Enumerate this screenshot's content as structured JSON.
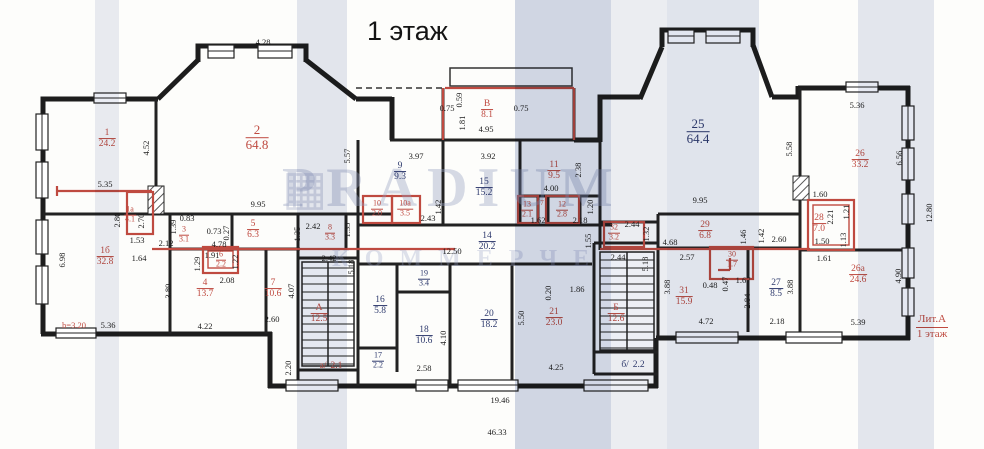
{
  "title": "1 этаж",
  "litera": {
    "line1": "Лит.А",
    "line2": "1 этаж"
  },
  "watermark": {
    "logo_icon": "grid-logo",
    "line1": "PRADIUM",
    "line2": "КОММЕРЧЕ"
  },
  "colors": {
    "markup_red": "#bf4a40",
    "room_blue": "#2f3b6e",
    "wall_black": "#1d1d1d",
    "scan_stripe": "#b7c0d8"
  },
  "rooms": [
    {
      "id": "1",
      "area": "24.2",
      "x": 107,
      "y": 139,
      "c": "r"
    },
    {
      "id": "2",
      "area": "64.8",
      "x": 257,
      "y": 138,
      "c": "r",
      "lg": 1
    },
    {
      "id": "1а",
      "area": "4.1",
      "x": 130,
      "y": 215,
      "c": "r",
      "sm": 1
    },
    {
      "id": "1б",
      "area": "32.8",
      "x": 105,
      "y": 257,
      "c": "r"
    },
    {
      "id": "3",
      "area": "3.1",
      "x": 184,
      "y": 235,
      "c": "r",
      "sm": 1
    },
    {
      "id": "4",
      "area": "13.7",
      "x": 205,
      "y": 289,
      "c": "r"
    },
    {
      "id": "5",
      "area": "6.3",
      "x": 253,
      "y": 230,
      "c": "r"
    },
    {
      "id": "6",
      "area": "2.2",
      "x": 221,
      "y": 260,
      "c": "r",
      "sm": 1
    },
    {
      "id": "7",
      "area": "10.6",
      "x": 273,
      "y": 289,
      "c": "r"
    },
    {
      "id": "8",
      "area": "3.3",
      "x": 330,
      "y": 233,
      "c": "r",
      "sm": 1
    },
    {
      "id": "9",
      "area": "9.3",
      "x": 400,
      "y": 172,
      "c": "b"
    },
    {
      "id": "10",
      "area": "2.0",
      "x": 377,
      "y": 209,
      "c": "r",
      "sm": 1
    },
    {
      "id": "10а",
      "area": "3.5",
      "x": 405,
      "y": 209,
      "c": "r",
      "sm": 1
    },
    {
      "id": "В",
      "area": "8.1",
      "x": 487,
      "y": 110,
      "c": "r"
    },
    {
      "id": "15",
      "area": "15.2",
      "x": 484,
      "y": 188,
      "c": "b"
    },
    {
      "id": "11",
      "area": "9.5",
      "x": 554,
      "y": 171,
      "c": "r"
    },
    {
      "id": "13",
      "area": "2.1",
      "x": 527,
      "y": 210,
      "c": "r",
      "sm": 1
    },
    {
      "id": "12",
      "area": "2.8",
      "x": 562,
      "y": 210,
      "c": "r",
      "sm": 1
    },
    {
      "id": "14",
      "area": "20.2",
      "x": 487,
      "y": 242,
      "c": "b"
    },
    {
      "id": "19",
      "area": "3.4",
      "x": 424,
      "y": 279,
      "c": "b",
      "sm": 1
    },
    {
      "id": "16",
      "area": "5.8",
      "x": 380,
      "y": 306,
      "c": "b"
    },
    {
      "id": "18",
      "area": "10.6",
      "x": 424,
      "y": 336,
      "c": "b"
    },
    {
      "id": "20",
      "area": "18.2",
      "x": 489,
      "y": 320,
      "c": "b"
    },
    {
      "id": "17",
      "area": "2.2",
      "x": 378,
      "y": 361,
      "c": "b",
      "sm": 1
    },
    {
      "id": "А",
      "area": "12.5",
      "x": 319,
      "y": 314,
      "c": "r"
    },
    {
      "id": "а/",
      "area": "2.1",
      "x": 330,
      "y": 366,
      "c": "r",
      "inline": 1
    },
    {
      "id": "21",
      "area": "23.0",
      "x": 554,
      "y": 318,
      "c": "r"
    },
    {
      "id": "Б",
      "area": "12.6",
      "x": 616,
      "y": 314,
      "c": "r"
    },
    {
      "id": "б/",
      "area": "2.2",
      "x": 632,
      "y": 365,
      "c": "b",
      "inline": 1
    },
    {
      "id": "25",
      "area": "64.4",
      "x": 698,
      "y": 132,
      "c": "b",
      "lg": 1
    },
    {
      "id": "29",
      "area": "6.8",
      "x": 705,
      "y": 231,
      "c": "r"
    },
    {
      "id": "30",
      "area": "1.7",
      "x": 732,
      "y": 260,
      "c": "r",
      "sm": 1
    },
    {
      "id": "31",
      "area": "15.9",
      "x": 684,
      "y": 297,
      "c": "r"
    },
    {
      "id": "27",
      "area": "8.5",
      "x": 776,
      "y": 289,
      "c": "b"
    },
    {
      "id": "32",
      "area": "3.2",
      "x": 614,
      "y": 233,
      "c": "r",
      "sm": 1
    },
    {
      "id": "28",
      "area": "7.0",
      "x": 819,
      "y": 224,
      "c": "r"
    },
    {
      "id": "26",
      "area": "33.2",
      "x": 860,
      "y": 160,
      "c": "r"
    },
    {
      "id": "26а",
      "area": "24.6",
      "x": 858,
      "y": 275,
      "c": "r"
    }
  ],
  "dims": [
    {
      "t": "4.28",
      "x": 263,
      "y": 42
    },
    {
      "t": "5.35",
      "x": 105,
      "y": 184
    },
    {
      "t": "4.52",
      "x": 146,
      "y": 148,
      "v": 1
    },
    {
      "t": "5.57",
      "x": 347,
      "y": 156,
      "v": 1
    },
    {
      "t": "9.95",
      "x": 258,
      "y": 204
    },
    {
      "t": "6.98",
      "x": 62,
      "y": 260,
      "v": 1
    },
    {
      "t": "2.80",
      "x": 117,
      "y": 220,
      "v": 1
    },
    {
      "t": "2.70",
      "x": 141,
      "y": 221,
      "v": 1
    },
    {
      "t": "1.53",
      "x": 137,
      "y": 240
    },
    {
      "t": "1.64",
      "x": 139,
      "y": 258
    },
    {
      "t": "5.36",
      "x": 108,
      "y": 325
    },
    {
      "t": "h=3.20",
      "x": 74,
      "y": 325,
      "red": 1
    },
    {
      "t": "2.12",
      "x": 166,
      "y": 243
    },
    {
      "t": "1.39",
      "x": 173,
      "y": 227,
      "v": 1
    },
    {
      "t": "0.83",
      "x": 187,
      "y": 218
    },
    {
      "t": "0.73",
      "x": 214,
      "y": 231
    },
    {
      "t": "0.27",
      "x": 226,
      "y": 233,
      "v": 1
    },
    {
      "t": "4.78",
      "x": 219,
      "y": 244
    },
    {
      "t": "1.29",
      "x": 197,
      "y": 264,
      "v": 1
    },
    {
      "t": "1.91",
      "x": 212,
      "y": 255
    },
    {
      "t": "1.22",
      "x": 235,
      "y": 262,
      "v": 1
    },
    {
      "t": "2.08",
      "x": 227,
      "y": 280
    },
    {
      "t": "3.89",
      "x": 168,
      "y": 291,
      "v": 1
    },
    {
      "t": "4.22",
      "x": 205,
      "y": 326
    },
    {
      "t": "2.60",
      "x": 272,
      "y": 319
    },
    {
      "t": "4.07",
      "x": 291,
      "y": 291,
      "v": 1
    },
    {
      "t": "2.42",
      "x": 313,
      "y": 226
    },
    {
      "t": "2.42",
      "x": 329,
      "y": 258
    },
    {
      "t": "1.35",
      "x": 297,
      "y": 234,
      "v": 1
    },
    {
      "t": "1.35",
      "x": 347,
      "y": 230,
      "v": 1
    },
    {
      "t": "5.18",
      "x": 351,
      "y": 267,
      "v": 1
    },
    {
      "t": "2.20",
      "x": 288,
      "y": 368,
      "v": 1
    },
    {
      "t": "3.97",
      "x": 416,
      "y": 156
    },
    {
      "t": "3.92",
      "x": 488,
      "y": 156
    },
    {
      "t": "4.95",
      "x": 486,
      "y": 129
    },
    {
      "t": "1.81",
      "x": 462,
      "y": 123,
      "v": 1
    },
    {
      "t": "0.59",
      "x": 459,
      "y": 100,
      "v": 1
    },
    {
      "t": "0.75",
      "x": 447,
      "y": 108
    },
    {
      "t": "0.75",
      "x": 521,
      "y": 108
    },
    {
      "t": "2.43",
      "x": 428,
      "y": 218
    },
    {
      "t": "1.42",
      "x": 438,
      "y": 207,
      "v": 1
    },
    {
      "t": "12.50",
      "x": 452,
      "y": 251
    },
    {
      "t": "2.58",
      "x": 424,
      "y": 368
    },
    {
      "t": "4.10",
      "x": 443,
      "y": 338,
      "v": 1
    },
    {
      "t": "2.38",
      "x": 578,
      "y": 170,
      "v": 1
    },
    {
      "t": "4.00",
      "x": 551,
      "y": 188
    },
    {
      "t": "7",
      "x": 542,
      "y": 203,
      "red": 1,
      "sm": 1
    },
    {
      "t": "1.62",
      "x": 538,
      "y": 220
    },
    {
      "t": "2.18",
      "x": 580,
      "y": 220
    },
    {
      "t": "1.20",
      "x": 590,
      "y": 207,
      "v": 1
    },
    {
      "t": "1.55",
      "x": 588,
      "y": 241,
      "v": 1
    },
    {
      "t": "0.20",
      "x": 548,
      "y": 293,
      "v": 1
    },
    {
      "t": "1.86",
      "x": 577,
      "y": 289
    },
    {
      "t": "5.50",
      "x": 521,
      "y": 318,
      "v": 1
    },
    {
      "t": "4.25",
      "x": 556,
      "y": 367
    },
    {
      "t": "2.44",
      "x": 632,
      "y": 224
    },
    {
      "t": "1.32",
      "x": 646,
      "y": 234,
      "v": 1
    },
    {
      "t": "2.44",
      "x": 618,
      "y": 257
    },
    {
      "t": "5.18",
      "x": 645,
      "y": 264,
      "v": 1
    },
    {
      "t": "9.95",
      "x": 700,
      "y": 200
    },
    {
      "t": "4.68",
      "x": 670,
      "y": 242
    },
    {
      "t": "2.57",
      "x": 687,
      "y": 257
    },
    {
      "t": "1.46",
      "x": 743,
      "y": 237,
      "v": 1
    },
    {
      "t": "1.42",
      "x": 761,
      "y": 236,
      "v": 1
    },
    {
      "t": "2.60",
      "x": 779,
      "y": 239
    },
    {
      "t": "0.48",
      "x": 710,
      "y": 285
    },
    {
      "t": "0.47",
      "x": 725,
      "y": 284,
      "v": 1
    },
    {
      "t": "1.67",
      "x": 743,
      "y": 280
    },
    {
      "t": "2.84",
      "x": 747,
      "y": 301,
      "v": 1
    },
    {
      "t": "3.88",
      "x": 667,
      "y": 287,
      "v": 1
    },
    {
      "t": "3.88",
      "x": 790,
      "y": 287,
      "v": 1
    },
    {
      "t": "4.72",
      "x": 706,
      "y": 321
    },
    {
      "t": "2.18",
      "x": 777,
      "y": 321
    },
    {
      "t": "5.36",
      "x": 857,
      "y": 105
    },
    {
      "t": "5.58",
      "x": 789,
      "y": 149,
      "v": 1
    },
    {
      "t": "6.56",
      "x": 899,
      "y": 158,
      "v": 1
    },
    {
      "t": "1.60",
      "x": 820,
      "y": 194
    },
    {
      "t": "2.21",
      "x": 830,
      "y": 217,
      "v": 1
    },
    {
      "t": "1.21",
      "x": 846,
      "y": 212,
      "v": 1
    },
    {
      "t": "1.50",
      "x": 822,
      "y": 241
    },
    {
      "t": "1.13",
      "x": 843,
      "y": 240,
      "v": 1
    },
    {
      "t": "1.61",
      "x": 824,
      "y": 258
    },
    {
      "t": "4.90",
      "x": 898,
      "y": 276,
      "v": 1
    },
    {
      "t": "5.39",
      "x": 858,
      "y": 322
    },
    {
      "t": "12.80",
      "x": 929,
      "y": 213,
      "v": 1
    },
    {
      "t": "19.46",
      "x": 500,
      "y": 400
    },
    {
      "t": "46.33",
      "x": 497,
      "y": 432
    }
  ]
}
